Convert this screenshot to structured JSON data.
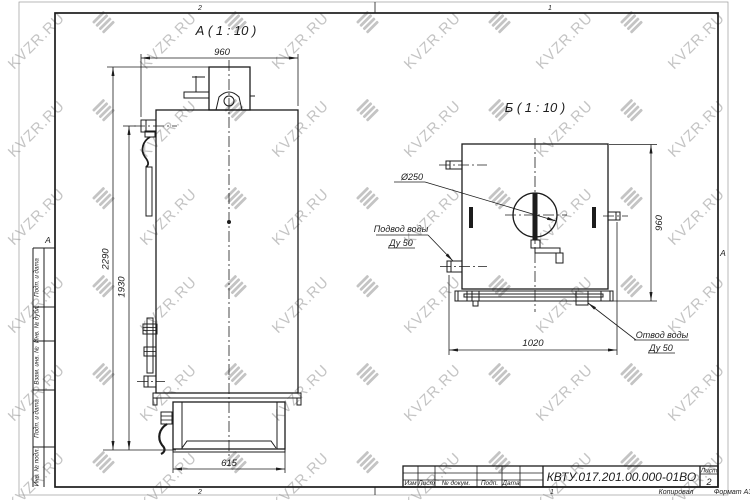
{
  "drawing": {
    "views": {
      "view_a": {
        "title": "А ( 1 : 10 )",
        "dims": {
          "top_width": "960",
          "overall_height": "2290",
          "inlet_height": "1930",
          "base_width": "615"
        }
      },
      "view_b": {
        "title": "Б ( 1 : 10 )",
        "dims": {
          "right_height": "960",
          "bottom_depth": "1020",
          "flue_diameter": "Ø250"
        },
        "callouts": {
          "inlet_line1": "Подвод воды",
          "inlet_line2": "Ду 50",
          "outlet_line1": "Отвод воды",
          "outlet_line2": "Ду 50"
        }
      }
    },
    "title_block": {
      "doc_number": "КВТУ.017.201.00.000-01ВО",
      "columns": [
        "Изм",
        "Лист",
        "№ докум.",
        "Подп.",
        "Дата"
      ],
      "sheet_label": "Лист",
      "sheet_number": "2"
    },
    "margins": {
      "side_labels": [
        "Подп. и дата",
        "Инв. № дубл.",
        "Взам. инв. №",
        "Подп. и дата",
        "Инв. № подл."
      ],
      "zone_top_left": "2",
      "zone_top_right": "1",
      "zone_bottom_left": "2",
      "zone_bottom_right": "1",
      "zone_letter_left": "А",
      "zone_letter_right": "А",
      "copied_label": "Копировал",
      "format_label": "Формат А3"
    },
    "watermark": {
      "text": "KVZR.RU",
      "color": "#c4c4c4"
    },
    "colors": {
      "ink": "#1c1c1c",
      "paper": "#ffffff"
    }
  }
}
